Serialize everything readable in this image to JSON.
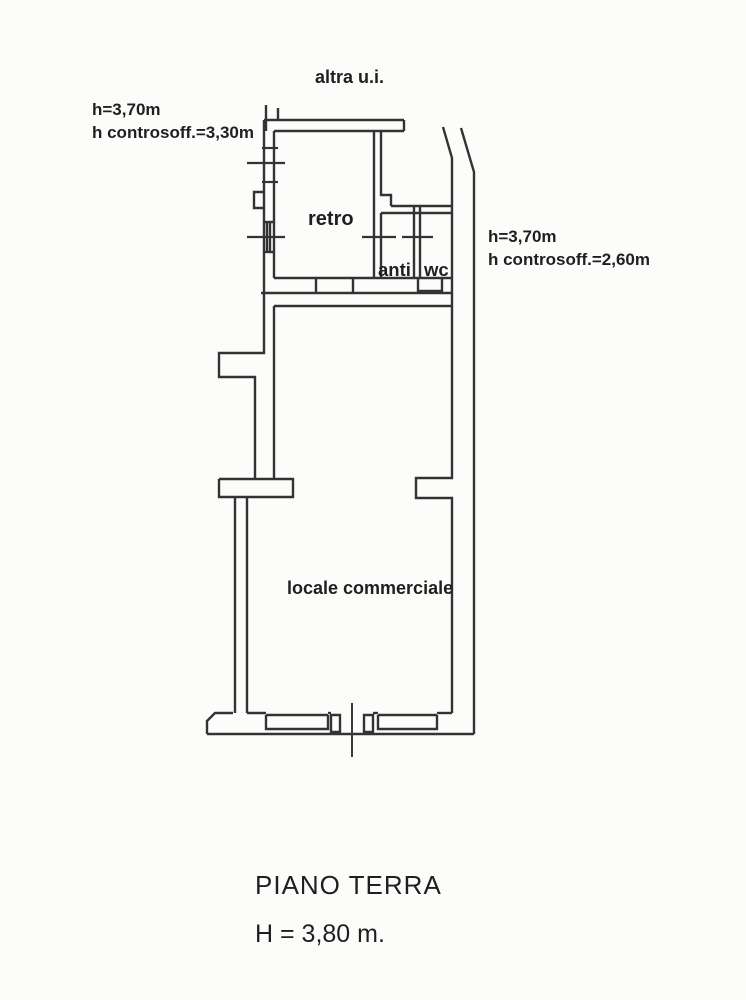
{
  "colors": {
    "ink": "#333333",
    "paper": "#fcfcfa",
    "text": "#1f1f1f"
  },
  "annotations": {
    "top_center": "altra u.i.",
    "left": {
      "line1": "h=3,70m",
      "line2": "h controsoff.=3,30m"
    },
    "right": {
      "line1": "h=3,70m",
      "line2": "h controsoff.=2,60m"
    }
  },
  "rooms": {
    "retro": {
      "label": "retro"
    },
    "anti": {
      "label": "anti"
    },
    "wc": {
      "label": "wc"
    },
    "locale": {
      "label": "locale commerciale"
    }
  },
  "footer": {
    "title": "PIANO TERRA",
    "height": "H = 3,80 m."
  }
}
